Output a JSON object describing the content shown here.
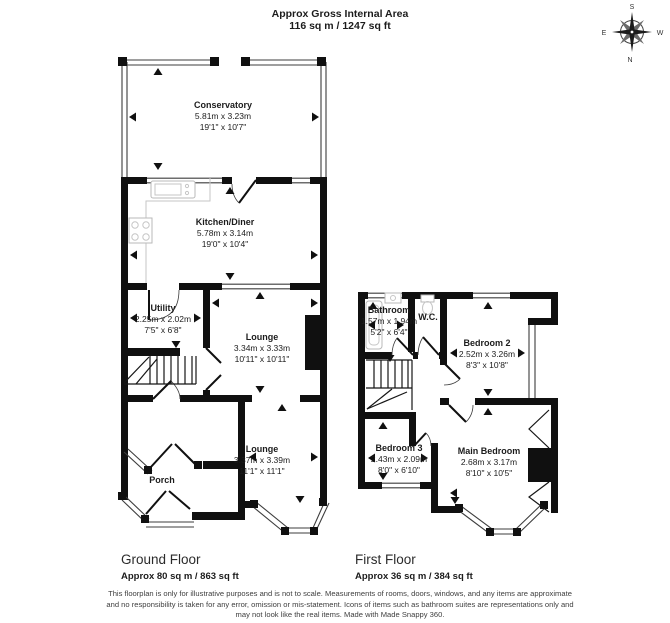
{
  "header": {
    "title": "Approx Gross Internal Area",
    "subtitle": "116 sq m / 1247 sq ft"
  },
  "compass": {
    "top": "S",
    "right": "W",
    "bottom": "N",
    "left": "E"
  },
  "floors": {
    "ground": {
      "label": "Ground Floor",
      "area": "Approx 80 sq m / 863 sq ft"
    },
    "first": {
      "label": "First Floor",
      "area": "Approx 36 sq m / 384 sq ft"
    }
  },
  "rooms": {
    "conservatory": {
      "name": "Conservatory",
      "metric": "5.81m x 3.23m",
      "imperial": "19'1\" x 10'7\""
    },
    "kitchen": {
      "name": "Kitchen/Diner",
      "metric": "5.78m x 3.14m",
      "imperial": "19'0\" x 10'4\""
    },
    "utility": {
      "name": "Utility",
      "metric": "2.25m x 2.02m",
      "imperial": "7'5\" x 6'8\""
    },
    "lounge1": {
      "name": "Lounge",
      "metric": "3.34m x 3.33m",
      "imperial": "10'11\" x 10'11\""
    },
    "lounge2": {
      "name": "Lounge",
      "metric": "3.37m x 3.39m",
      "imperial": "11'1\" x 11'1\""
    },
    "porch": {
      "name": "Porch"
    },
    "bathroom": {
      "name": "Bathroom",
      "metric": "1.57m x 1.94m",
      "imperial": "5'2\" x 6'4\""
    },
    "wc": {
      "name": "W.C."
    },
    "bedroom2": {
      "name": "Bedroom 2",
      "metric": "2.52m x 3.26m",
      "imperial": "8'3\" x 10'8\""
    },
    "bedroom3": {
      "name": "Bedroom 3",
      "metric": "2.43m x 2.09m",
      "imperial": "8'0\" x 6'10\""
    },
    "main_bedroom": {
      "name": "Main Bedroom",
      "metric": "2.68m x 3.17m",
      "imperial": "8'10\" x 10'5\""
    }
  },
  "disclaimer": "This floorplan is only for illustrative purposes and is not to scale. Measurements of rooms, doors, windows, and any items are approximate and no responsibility is taken for any error, omission or mis-statement. Icons of items such as bathroom suites are representations only and may not look like the real items. Made with Made Snappy 360."
}
